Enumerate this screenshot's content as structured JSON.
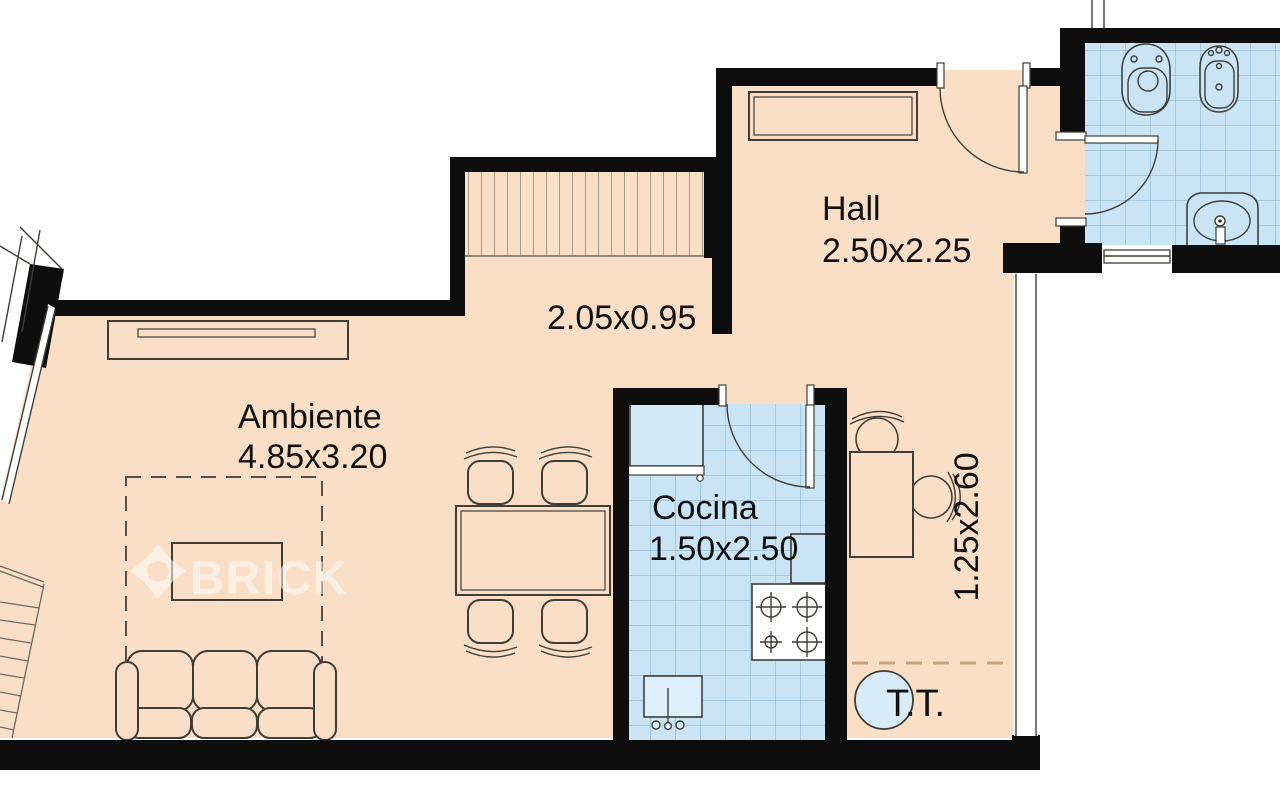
{
  "rooms": {
    "hall": {
      "name": "Hall",
      "size": "2.50x2.25"
    },
    "corridor": {
      "size": "2.05x0.95"
    },
    "living": {
      "name": "Ambiente",
      "size": "4.85x3.20"
    },
    "kitchen": {
      "name": "Cocina",
      "size": "1.50x2.50"
    },
    "balcony": {
      "size": "1.25x2.60"
    },
    "laundry": {
      "label": "T.T."
    }
  },
  "watermark": {
    "text": "BRICK"
  },
  "colors": {
    "floor": "#FADFC6",
    "tile": "#C9E4F5",
    "tile_grid": "#85AECC",
    "wall": "#0E0E0E",
    "line": "#3F3F37",
    "laundry_circle": "#D9ECF9",
    "dashed_boundary": "#C9A182"
  }
}
